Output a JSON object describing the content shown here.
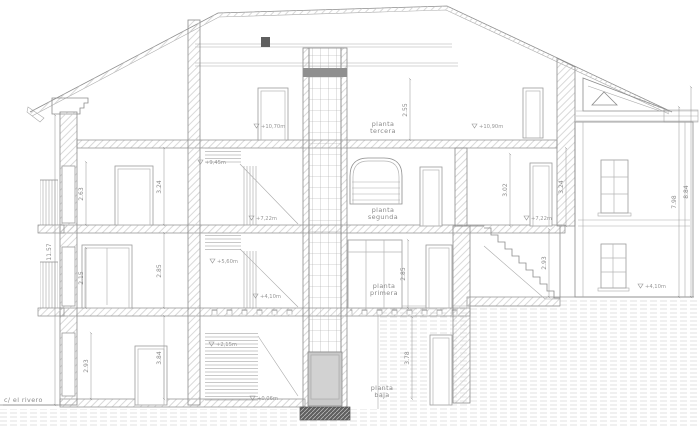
{
  "sheet": {
    "type": "architectural-section-drawing",
    "background_color": "#ffffff",
    "line_color": "#8c8c8c",
    "cab_fill_color": "#c9c9c9"
  },
  "street_label": "c/ el rivero",
  "floor_labels": {
    "tercera": {
      "line1": "planta",
      "line2": "tercera"
    },
    "segunda": {
      "line1": "planta",
      "line2": "segunda"
    },
    "primera": {
      "line1": "planta",
      "line2": "primera"
    },
    "baja": {
      "line1": "planta",
      "line2": "baja"
    }
  },
  "level_markers": {
    "third_center": "+10,70m",
    "third_rear": "+10,90m",
    "stair_945": "+9,45m",
    "second_center": "+7,22m",
    "second_rear": "+7,22m",
    "stair_560": "+5,60m",
    "first_center": "+4,10m",
    "ground_rear": "+4,10m",
    "stair_215": "+2,15m",
    "ground_street": "+0,06m"
  },
  "dimensions": {
    "left_total": "11.57",
    "left_t3_opening": "2.63",
    "left_t3_floor": "3.24",
    "left_t2_opening": "2.15",
    "left_t2_floor": "2.85",
    "left_t1_opening": "2.93",
    "left_t1_floor": "3.84",
    "mid_t3_height": "2.55",
    "mid_t2_height": "3.02",
    "rear_t2_height": "3.24",
    "mid_t1_height": "2.85",
    "mid_t0_height": "3.78",
    "rear_stair_height": "2.93",
    "right_total_inner": "7.98",
    "right_total_outer": "8.84"
  }
}
